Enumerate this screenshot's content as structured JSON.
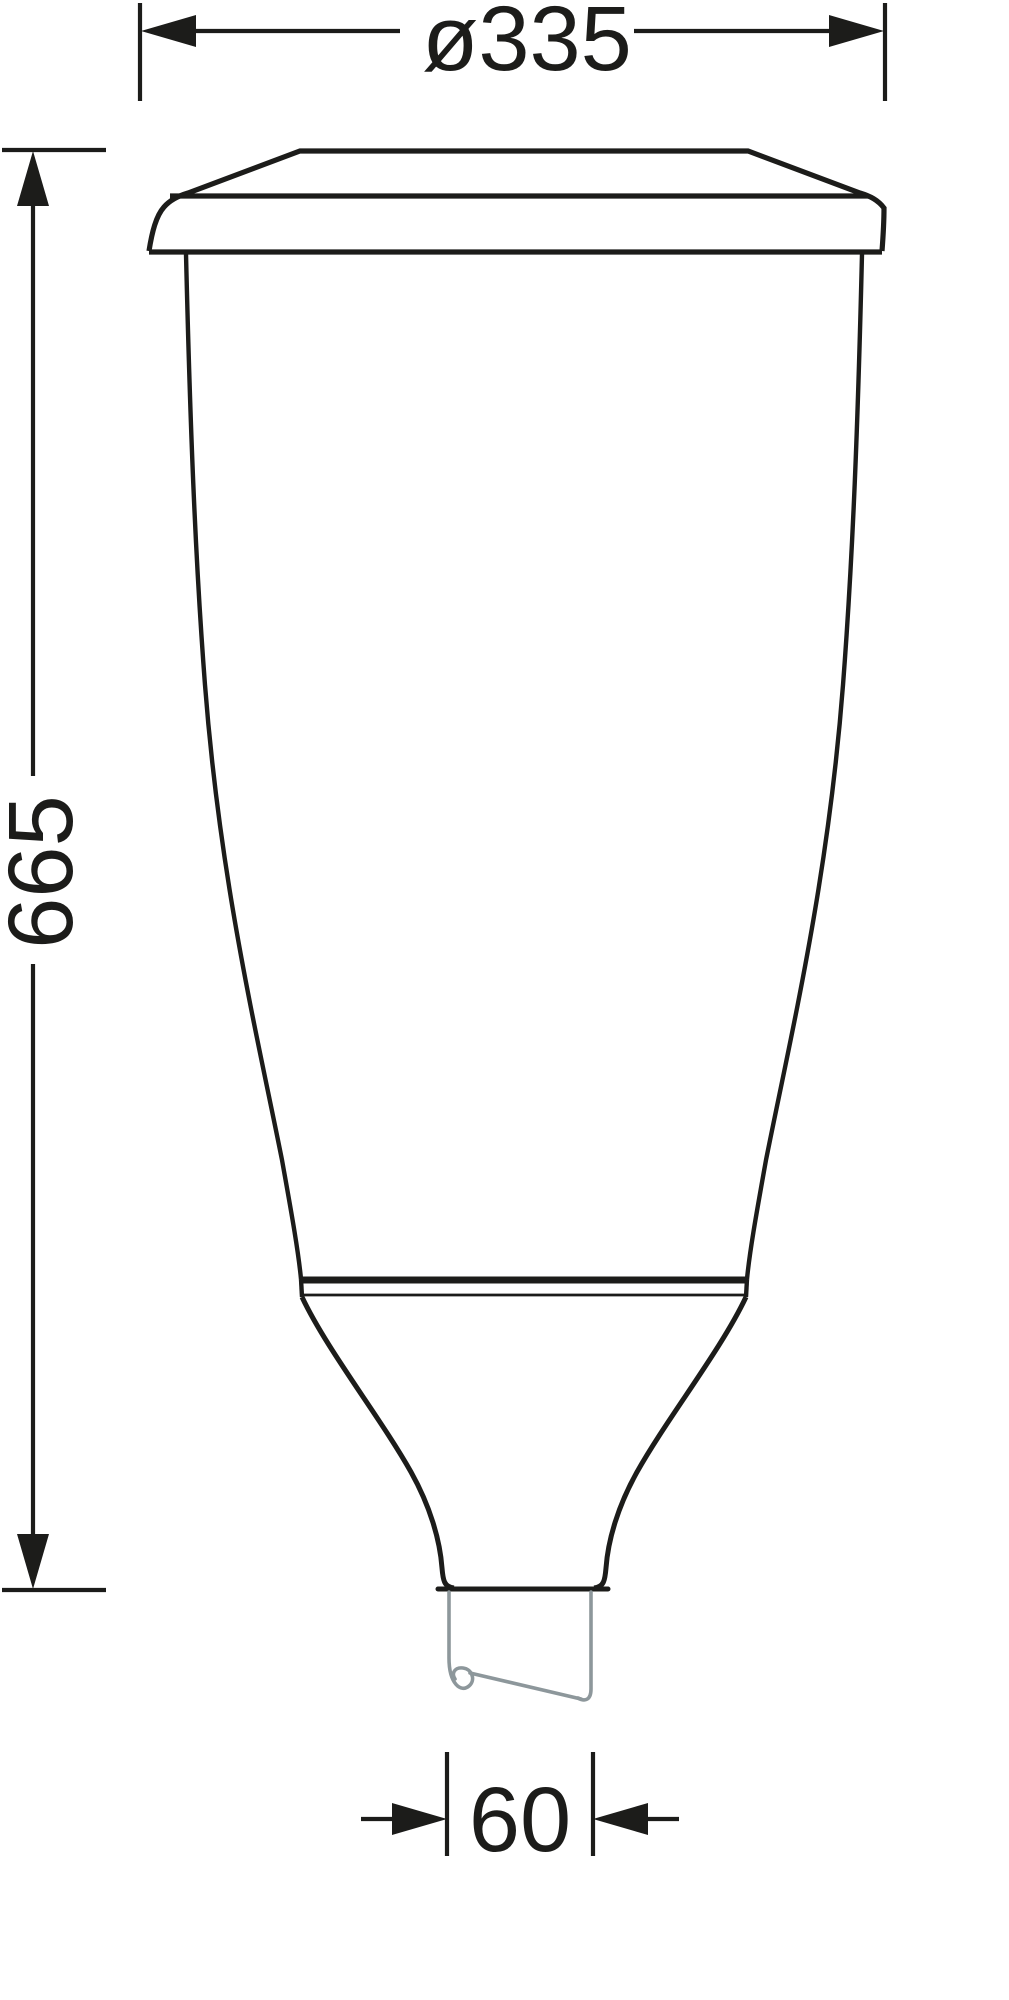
{
  "drawing": {
    "labels": {
      "diameter": "ø335",
      "height": "665",
      "spigot_width": "60"
    },
    "colors": {
      "ink": "#1c1c1a",
      "spigot_gray": "#8d979b",
      "background": "#ffffff"
    }
  }
}
